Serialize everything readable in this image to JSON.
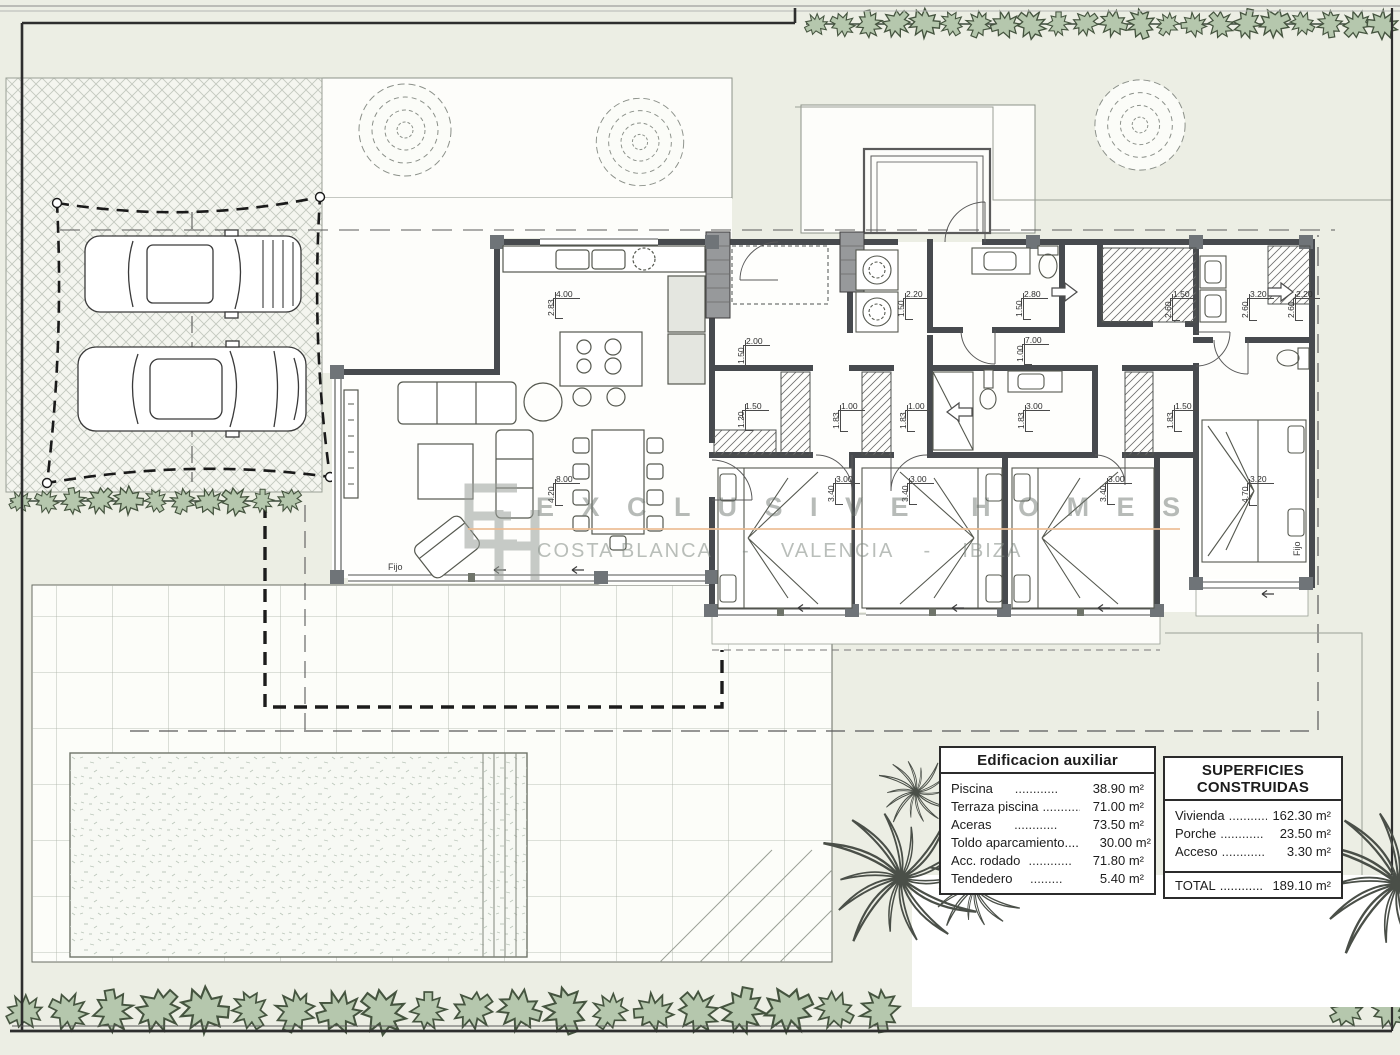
{
  "watermark": {
    "logo_monogram": "EH",
    "title": "E X C L U S I V E   H O M E S",
    "subtitle": "COSTA BLANCA    -    VALENCIA    -    IBIZA",
    "accent_color": "#ecbd94"
  },
  "tables": {
    "auxiliary": {
      "title": "Edificacion auxiliar",
      "rows": [
        {
          "label": "Piscina",
          "dots": "............",
          "value": "38.90 m²"
        },
        {
          "label": "Terraza piscina",
          "dots": "............",
          "value": "71.00 m²"
        },
        {
          "label": "Aceras",
          "dots": "............",
          "value": "73.50 m²"
        },
        {
          "label": "Toldo aparcamiento....",
          "dots": "",
          "value": "30.00 m²"
        },
        {
          "label": "Acc. rodado",
          "dots": "............",
          "value": "71.80 m²"
        },
        {
          "label": "Tendedero",
          "dots": ".........",
          "value": "5.40 m²"
        }
      ]
    },
    "built": {
      "title": "SUPERFICIES CONSTRUIDAS",
      "rows": [
        {
          "label": "Vivienda",
          "dots": "............",
          "value": "162.30 m²"
        },
        {
          "label": "Porche",
          "dots": "............",
          "value": "23.50 m²"
        },
        {
          "label": "Acceso",
          "dots": "............",
          "value": "3.30 m²"
        }
      ],
      "total": {
        "label": "TOTAL",
        "dots": "............",
        "value": "189.10 m²"
      }
    }
  },
  "plan_labels": [
    {
      "text": "Fijo",
      "x": 388,
      "y": 562
    },
    {
      "text": "Fijo",
      "x": 1292,
      "y": 556,
      "rot": -90
    }
  ],
  "dimensions": [
    {
      "text": "4.00",
      "x": 556,
      "y": 289
    },
    {
      "text": "2.83",
      "x": 546,
      "y": 316,
      "rot": -90
    },
    {
      "text": "2.00",
      "x": 746,
      "y": 336
    },
    {
      "text": "1.50",
      "x": 736,
      "y": 364,
      "rot": -90
    },
    {
      "text": "2.20",
      "x": 906,
      "y": 289
    },
    {
      "text": "1.50",
      "x": 896,
      "y": 317,
      "rot": -90
    },
    {
      "text": "2.80",
      "x": 1024,
      "y": 289
    },
    {
      "text": "1.50",
      "x": 1014,
      "y": 317,
      "rot": -90
    },
    {
      "text": "1.50",
      "x": 1173,
      "y": 289
    },
    {
      "text": "2.60",
      "x": 1163,
      "y": 318,
      "rot": -90
    },
    {
      "text": "3.20",
      "x": 1250,
      "y": 289
    },
    {
      "text": "2.60",
      "x": 1240,
      "y": 318,
      "rot": -90
    },
    {
      "text": "2.20",
      "x": 1296,
      "y": 289
    },
    {
      "text": "2.60",
      "x": 1286,
      "y": 318,
      "rot": -90
    },
    {
      "text": "7.00",
      "x": 1025,
      "y": 335
    },
    {
      "text": "1.00",
      "x": 1015,
      "y": 362,
      "rot": -90
    },
    {
      "text": "1.50",
      "x": 745,
      "y": 401
    },
    {
      "text": "1.20",
      "x": 736,
      "y": 428,
      "rot": -90
    },
    {
      "text": "1.00",
      "x": 841,
      "y": 401
    },
    {
      "text": "1.83",
      "x": 831,
      "y": 429,
      "rot": -90
    },
    {
      "text": "1.00",
      "x": 908,
      "y": 401
    },
    {
      "text": "1.83",
      "x": 898,
      "y": 429,
      "rot": -90
    },
    {
      "text": "3.00",
      "x": 1026,
      "y": 401
    },
    {
      "text": "1.83",
      "x": 1016,
      "y": 429,
      "rot": -90
    },
    {
      "text": "1.50",
      "x": 1175,
      "y": 401
    },
    {
      "text": "1.83",
      "x": 1165,
      "y": 429,
      "rot": -90
    },
    {
      "text": "8.00",
      "x": 556,
      "y": 474
    },
    {
      "text": "4.20",
      "x": 546,
      "y": 503,
      "rot": -90
    },
    {
      "text": "3.00",
      "x": 836,
      "y": 474
    },
    {
      "text": "3.40",
      "x": 826,
      "y": 502,
      "rot": -90
    },
    {
      "text": "3.00",
      "x": 910,
      "y": 474
    },
    {
      "text": "3.40",
      "x": 900,
      "y": 502,
      "rot": -90
    },
    {
      "text": "3.00",
      "x": 1108,
      "y": 474
    },
    {
      "text": "3.40",
      "x": 1098,
      "y": 502,
      "rot": -90
    },
    {
      "text": "3.20",
      "x": 1250,
      "y": 474
    },
    {
      "text": "4.70",
      "x": 1240,
      "y": 503,
      "rot": -90
    }
  ]
}
